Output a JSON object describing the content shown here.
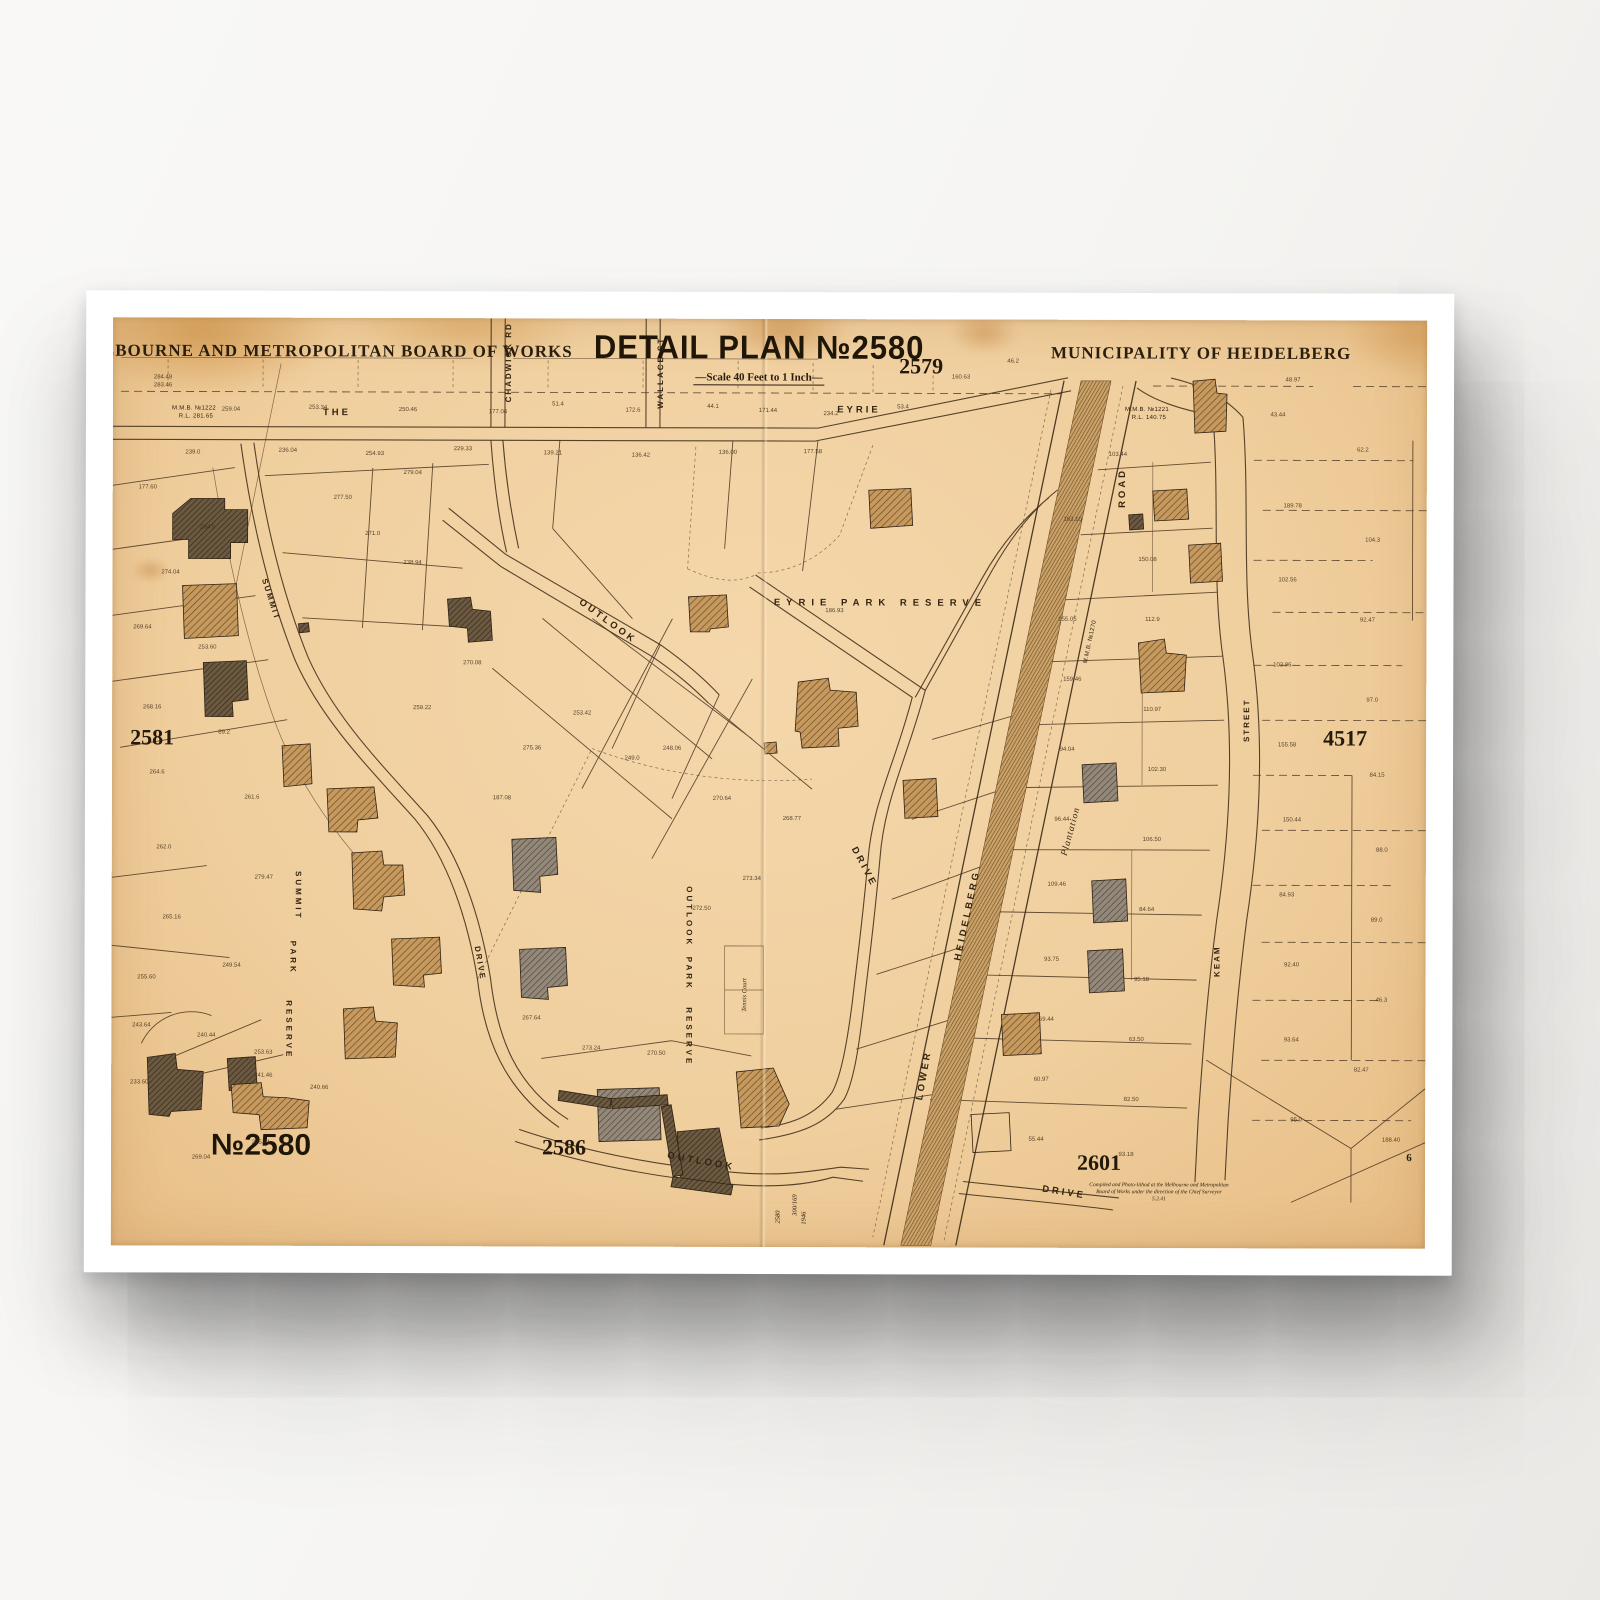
{
  "scene": {
    "description": "Framed vintage cadastral map print hanging on a wall"
  },
  "colors": {
    "paper": "#f0cf9e",
    "ink": "#3c2a16",
    "frame": "#ffffff",
    "wall": "#f6f5f3",
    "building_tan": "#c69a5f",
    "building_gray": "#938879",
    "building_dark": "#6b5a41",
    "plantation": "#7a5426"
  },
  "map": {
    "header": {
      "board_title": "MELBOURNE AND METROPOLITAN BOARD OF WORKS",
      "plan_title": "DETAIL PLAN №2580",
      "scale_note": "—Scale 40 Feet to 1 Inch—",
      "municipality": "MUNICIPALITY OF HEIDELBERG"
    },
    "labels": [
      {
        "id": "board-title",
        "t": "MELBOURNE AND METROPOLITAN BOARD OF WORKS",
        "x": 210,
        "y": 33,
        "c": "t-board"
      },
      {
        "id": "plan-title",
        "t": "DETAIL PLAN №2580",
        "x": 646,
        "y": 28,
        "c": "t-plan"
      },
      {
        "id": "scale-note",
        "t": "—Scale 40 Feet to 1 Inch—",
        "x": 646,
        "y": 60,
        "c": "t-scale"
      },
      {
        "id": "municipality",
        "t": "MUNICIPALITY OF HEIDELBERG",
        "x": 1088,
        "y": 33,
        "c": "t-muni"
      },
      {
        "id": "adj-plan-2579",
        "t": "2579",
        "x": 808,
        "y": 47,
        "c": "t-adj"
      },
      {
        "id": "adj-plan-2581",
        "t": "2581",
        "x": 40,
        "y": 420,
        "c": "t-adj"
      },
      {
        "id": "adj-plan-4517",
        "t": "4517",
        "x": 1233,
        "y": 418,
        "c": "t-adj"
      },
      {
        "id": "plan-no-2580",
        "t": "№2580",
        "x": 150,
        "y": 828,
        "c": "t-adj-big"
      },
      {
        "id": "adj-plan-2586",
        "t": "2586",
        "x": 453,
        "y": 829,
        "c": "t-adj"
      },
      {
        "id": "adj-plan-2601",
        "t": "2601",
        "x": 988,
        "y": 843,
        "c": "t-adj"
      },
      {
        "id": "street-the",
        "t": "THE",
        "x": 224,
        "y": 95,
        "c": "t-street"
      },
      {
        "id": "street-eyrie",
        "t": "EYRIE",
        "x": 746,
        "y": 91,
        "c": "t-street"
      },
      {
        "id": "street-chadwick",
        "t": "CHADWICK RD",
        "x": 396,
        "y": 44,
        "r": -90,
        "c": "t-street-sm"
      },
      {
        "id": "street-wallace",
        "t": "WALLACE ST",
        "x": 548,
        "y": 54,
        "r": -90,
        "c": "t-street-sm"
      },
      {
        "id": "street-summit",
        "t": "SUMMIT",
        "x": 158,
        "y": 282,
        "r": 72,
        "c": "t-street-sm"
      },
      {
        "id": "street-summit-drive",
        "t": "DRIVE",
        "x": 368,
        "y": 645,
        "r": 80,
        "c": "t-street-sm"
      },
      {
        "id": "street-outlook-upper",
        "t": "OUTLOOK",
        "x": 495,
        "y": 303,
        "r": 36,
        "c": "t-street"
      },
      {
        "id": "street-drive-upper",
        "t": "DRIVE",
        "x": 752,
        "y": 548,
        "r": 62,
        "c": "t-street"
      },
      {
        "id": "street-outlook-lower",
        "t": "OUTLOOK",
        "x": 590,
        "y": 843,
        "r": 10,
        "c": "t-street"
      },
      {
        "id": "street-drive-lower",
        "t": "DRIVE",
        "x": 953,
        "y": 873,
        "r": 9,
        "c": "t-street"
      },
      {
        "id": "street-lower",
        "t": "LOWER",
        "x": 813,
        "y": 756,
        "r": -80,
        "c": "t-street"
      },
      {
        "id": "street-heidelberg",
        "t": "HEIDELBERG",
        "x": 856,
        "y": 596,
        "r": -78,
        "c": "t-street"
      },
      {
        "id": "street-road",
        "t": "ROAD",
        "x": 1010,
        "y": 168,
        "r": -90,
        "c": "t-street"
      },
      {
        "id": "plantation",
        "t": "Plantation",
        "x": 960,
        "y": 512,
        "r": -75,
        "c": "t-plant"
      },
      {
        "id": "street-keam",
        "t": "KEAM",
        "x": 1106,
        "y": 641,
        "r": -90,
        "c": "t-street-sm"
      },
      {
        "id": "street-street",
        "t": "STREET",
        "x": 1135,
        "y": 400,
        "r": -90,
        "c": "t-street-sm"
      },
      {
        "id": "eyrie-park-reserve",
        "t": "EYRIE  PARK  RESERVE",
        "x": 768,
        "y": 284,
        "c": "t-reserve"
      },
      {
        "id": "outlook-park-1",
        "t": "OUTLOOK",
        "x": 577,
        "y": 598,
        "r": 90,
        "c": "t-reserve-sm"
      },
      {
        "id": "outlook-park-2",
        "t": "PARK",
        "x": 577,
        "y": 655,
        "r": 90,
        "c": "t-reserve-sm"
      },
      {
        "id": "outlook-park-3",
        "t": "RESERVE",
        "x": 577,
        "y": 718,
        "r": 90,
        "c": "t-reserve-sm"
      },
      {
        "id": "summit-park-1",
        "t": "SUMMIT",
        "x": 186,
        "y": 578,
        "r": 90,
        "c": "t-reserve-sm"
      },
      {
        "id": "summit-park-2",
        "t": "PARK",
        "x": 181,
        "y": 640,
        "r": 90,
        "c": "t-reserve-sm"
      },
      {
        "id": "summit-park-3",
        "t": "RESERVE",
        "x": 177,
        "y": 712,
        "r": 90,
        "c": "t-reserve-sm"
      },
      {
        "id": "mmb-1222",
        "t": "M.M.B. №1222",
        "x": 81,
        "y": 91,
        "c": "t-tiny"
      },
      {
        "id": "mmb-1222-rl",
        "t": "R.L. 281.65",
        "x": 83,
        "y": 99,
        "c": "t-tiny"
      },
      {
        "id": "mmb-1221",
        "t": "M.M.B. №1221",
        "x": 1034,
        "y": 90,
        "c": "t-tiny"
      },
      {
        "id": "mmb-1221-rl",
        "t": "R.L. 140.75",
        "x": 1036,
        "y": 98,
        "c": "t-tiny"
      },
      {
        "id": "mmb-1270",
        "t": "M.M.B. №1270",
        "x": 978,
        "y": 322,
        "r": -78,
        "c": "t-tiny"
      },
      {
        "id": "tennis-court",
        "t": "Tennis Court",
        "x": 634,
        "y": 676,
        "r": -90,
        "c": "t-hand"
      },
      {
        "id": "compiled-note-1",
        "t": "Compiled and Photo-lithod at the Melbourne and Metropolitan",
        "x": 1048,
        "y": 866,
        "c": "t-note"
      },
      {
        "id": "compiled-note-2",
        "t": "Board of Works under the direction of the Chief Surveyor",
        "x": 1048,
        "y": 873,
        "c": "t-note"
      },
      {
        "id": "compiled-note-3",
        "t": "5.2.41",
        "x": 1048,
        "y": 880,
        "c": "t-note"
      },
      {
        "id": "fold-note-a",
        "t": "2580",
        "x": 668,
        "y": 898,
        "r": -90,
        "c": "t-hand"
      },
      {
        "id": "fold-note-b",
        "t": "300/169",
        "x": 685,
        "y": 886,
        "r": -90,
        "c": "t-hand"
      },
      {
        "id": "fold-note-c",
        "t": "1946",
        "x": 694,
        "y": 899,
        "r": -90,
        "c": "t-hand"
      },
      {
        "id": "mark-6",
        "t": "6",
        "x": 1298,
        "y": 838,
        "c": "t-six"
      },
      {
        "t": "284.48",
        "x": 50,
        "y": 60,
        "c": "lot"
      },
      {
        "t": "283.46",
        "x": 50,
        "y": 68,
        "c": "lot"
      },
      {
        "t": "259.04",
        "x": 118,
        "y": 92,
        "c": "lot"
      },
      {
        "t": "253.34",
        "x": 205,
        "y": 90,
        "c": "lot"
      },
      {
        "t": "250.46",
        "x": 295,
        "y": 92,
        "c": "lot"
      },
      {
        "t": "177.04",
        "x": 385,
        "y": 94,
        "c": "lot"
      },
      {
        "t": "51.4",
        "x": 445,
        "y": 86,
        "c": "lot"
      },
      {
        "t": "172.6",
        "x": 520,
        "y": 92,
        "c": "lot"
      },
      {
        "t": "44.1",
        "x": 600,
        "y": 88,
        "c": "lot"
      },
      {
        "t": "171.44",
        "x": 655,
        "y": 92,
        "c": "lot"
      },
      {
        "t": "234.2",
        "x": 718,
        "y": 95,
        "c": "lot"
      },
      {
        "t": "53.4",
        "x": 790,
        "y": 88,
        "c": "lot"
      },
      {
        "t": "160.63",
        "x": 848,
        "y": 58,
        "c": "lot"
      },
      {
        "t": "46.2",
        "x": 900,
        "y": 42,
        "c": "lot"
      },
      {
        "t": "239.0",
        "x": 80,
        "y": 135,
        "c": "lot"
      },
      {
        "t": "236.04",
        "x": 175,
        "y": 133,
        "c": "lot"
      },
      {
        "t": "254.93",
        "x": 262,
        "y": 136,
        "c": "lot"
      },
      {
        "t": "229.33",
        "x": 350,
        "y": 131,
        "c": "lot"
      },
      {
        "t": "139.21",
        "x": 440,
        "y": 135,
        "c": "lot"
      },
      {
        "t": "136.42",
        "x": 528,
        "y": 137,
        "c": "lot"
      },
      {
        "t": "136.00",
        "x": 615,
        "y": 134,
        "c": "lot"
      },
      {
        "t": "177.58",
        "x": 700,
        "y": 133,
        "c": "lot"
      },
      {
        "t": "177.60",
        "x": 35,
        "y": 170,
        "c": "lot"
      },
      {
        "t": "284.5",
        "x": 95,
        "y": 210,
        "c": "lot"
      },
      {
        "t": "274.04",
        "x": 58,
        "y": 255,
        "c": "lot"
      },
      {
        "t": "269.64",
        "x": 30,
        "y": 310,
        "c": "lot"
      },
      {
        "t": "253.60",
        "x": 95,
        "y": 330,
        "c": "lot"
      },
      {
        "t": "268.16",
        "x": 40,
        "y": 390,
        "c": "lot"
      },
      {
        "t": "89.2",
        "x": 112,
        "y": 415,
        "c": "lot"
      },
      {
        "t": "264.6",
        "x": 45,
        "y": 455,
        "c": "lot"
      },
      {
        "t": "261.6",
        "x": 140,
        "y": 480,
        "c": "lot"
      },
      {
        "t": "262.0",
        "x": 52,
        "y": 530,
        "c": "lot"
      },
      {
        "t": "279.47",
        "x": 152,
        "y": 560,
        "c": "lot"
      },
      {
        "t": "265.16",
        "x": 60,
        "y": 600,
        "c": "lot"
      },
      {
        "t": "255.60",
        "x": 35,
        "y": 660,
        "c": "lot"
      },
      {
        "t": "249.54",
        "x": 120,
        "y": 648,
        "c": "lot"
      },
      {
        "t": "243.64",
        "x": 30,
        "y": 708,
        "c": "lot"
      },
      {
        "t": "240.44",
        "x": 95,
        "y": 718,
        "c": "lot"
      },
      {
        "t": "253.63",
        "x": 152,
        "y": 735,
        "c": "lot"
      },
      {
        "t": "233.60",
        "x": 28,
        "y": 765,
        "c": "lot"
      },
      {
        "t": "269.04",
        "x": 90,
        "y": 840,
        "c": "lot"
      },
      {
        "t": "275.41",
        "x": 150,
        "y": 825,
        "c": "lot"
      },
      {
        "t": "241.46",
        "x": 152,
        "y": 758,
        "c": "lot"
      },
      {
        "t": "240.66",
        "x": 208,
        "y": 770,
        "c": "lot"
      },
      {
        "t": "271.0",
        "x": 260,
        "y": 216,
        "c": "lot"
      },
      {
        "t": "238.94",
        "x": 300,
        "y": 245,
        "c": "lot"
      },
      {
        "t": "279.04",
        "x": 300,
        "y": 155,
        "c": "lot"
      },
      {
        "t": "277.50",
        "x": 230,
        "y": 180,
        "c": "lot"
      },
      {
        "t": "270.08",
        "x": 360,
        "y": 345,
        "c": "lot"
      },
      {
        "t": "259.22",
        "x": 310,
        "y": 390,
        "c": "lot"
      },
      {
        "t": "275.36",
        "x": 420,
        "y": 430,
        "c": "lot"
      },
      {
        "t": "253.42",
        "x": 470,
        "y": 395,
        "c": "lot"
      },
      {
        "t": "249.0",
        "x": 520,
        "y": 440,
        "c": "lot"
      },
      {
        "t": "187.08",
        "x": 390,
        "y": 480,
        "c": "lot"
      },
      {
        "t": "248.06",
        "x": 560,
        "y": 430,
        "c": "lot"
      },
      {
        "t": "270.64",
        "x": 610,
        "y": 480,
        "c": "lot"
      },
      {
        "t": "268.77",
        "x": 680,
        "y": 500,
        "c": "lot"
      },
      {
        "t": "273.34",
        "x": 640,
        "y": 560,
        "c": "lot"
      },
      {
        "t": "272.50",
        "x": 590,
        "y": 590,
        "c": "lot"
      },
      {
        "t": "186.93",
        "x": 722,
        "y": 292,
        "c": "lot"
      },
      {
        "t": "267.64",
        "x": 420,
        "y": 700,
        "c": "lot"
      },
      {
        "t": "273.24",
        "x": 480,
        "y": 730,
        "c": "lot"
      },
      {
        "t": "270.50",
        "x": 545,
        "y": 735,
        "c": "lot"
      },
      {
        "t": "163.10",
        "x": 960,
        "y": 200,
        "c": "lot"
      },
      {
        "t": "103.44",
        "x": 1005,
        "y": 135,
        "c": "lot"
      },
      {
        "t": "150.08",
        "x": 1035,
        "y": 240,
        "c": "lot"
      },
      {
        "t": "155.05",
        "x": 955,
        "y": 300,
        "c": "lot"
      },
      {
        "t": "112.9",
        "x": 1040,
        "y": 300,
        "c": "lot"
      },
      {
        "t": "159.46",
        "x": 960,
        "y": 360,
        "c": "lot"
      },
      {
        "t": "110.97",
        "x": 1040,
        "y": 390,
        "c": "lot"
      },
      {
        "t": "94.04",
        "x": 955,
        "y": 430,
        "c": "lot"
      },
      {
        "t": "102.30",
        "x": 1045,
        "y": 450,
        "c": "lot"
      },
      {
        "t": "96.44",
        "x": 950,
        "y": 500,
        "c": "lot"
      },
      {
        "t": "106.50",
        "x": 1040,
        "y": 520,
        "c": "lot"
      },
      {
        "t": "109.46",
        "x": 945,
        "y": 565,
        "c": "lot"
      },
      {
        "t": "84.64",
        "x": 1035,
        "y": 590,
        "c": "lot"
      },
      {
        "t": "93.75",
        "x": 940,
        "y": 640,
        "c": "lot"
      },
      {
        "t": "95.18",
        "x": 1030,
        "y": 660,
        "c": "lot"
      },
      {
        "t": "69.44",
        "x": 935,
        "y": 700,
        "c": "lot"
      },
      {
        "t": "63.50",
        "x": 1025,
        "y": 720,
        "c": "lot"
      },
      {
        "t": "60.97",
        "x": 930,
        "y": 760,
        "c": "lot"
      },
      {
        "t": "82.50",
        "x": 1020,
        "y": 780,
        "c": "lot"
      },
      {
        "t": "55.44",
        "x": 925,
        "y": 820,
        "c": "lot"
      },
      {
        "t": "93.18",
        "x": 1015,
        "y": 835,
        "c": "lot"
      },
      {
        "t": "48.97",
        "x": 1180,
        "y": 60,
        "c": "lot"
      },
      {
        "t": "43.44",
        "x": 1165,
        "y": 95,
        "c": "lot"
      },
      {
        "t": "62.2",
        "x": 1250,
        "y": 130,
        "c": "lot"
      },
      {
        "t": "189.78",
        "x": 1180,
        "y": 186,
        "c": "lot"
      },
      {
        "t": "104.3",
        "x": 1260,
        "y": 220,
        "c": "lot"
      },
      {
        "t": "102.56",
        "x": 1175,
        "y": 260,
        "c": "lot"
      },
      {
        "t": "92.47",
        "x": 1255,
        "y": 300,
        "c": "lot"
      },
      {
        "t": "103.96",
        "x": 1170,
        "y": 345,
        "c": "lot"
      },
      {
        "t": "97.0",
        "x": 1260,
        "y": 380,
        "c": "lot"
      },
      {
        "t": "155.58",
        "x": 1175,
        "y": 425,
        "c": "lot"
      },
      {
        "t": "84.15",
        "x": 1265,
        "y": 455,
        "c": "lot"
      },
      {
        "t": "150.44",
        "x": 1180,
        "y": 500,
        "c": "lot"
      },
      {
        "t": "88.0",
        "x": 1270,
        "y": 530,
        "c": "lot"
      },
      {
        "t": "84.93",
        "x": 1175,
        "y": 575,
        "c": "lot"
      },
      {
        "t": "89.0",
        "x": 1265,
        "y": 600,
        "c": "lot"
      },
      {
        "t": "92.40",
        "x": 1180,
        "y": 645,
        "c": "lot"
      },
      {
        "t": "46.3",
        "x": 1270,
        "y": 680,
        "c": "lot"
      },
      {
        "t": "93.64",
        "x": 1180,
        "y": 720,
        "c": "lot"
      },
      {
        "t": "82.47",
        "x": 1250,
        "y": 750,
        "c": "lot"
      },
      {
        "t": "95.0",
        "x": 1185,
        "y": 800,
        "c": "lot"
      },
      {
        "t": "188.40",
        "x": 1280,
        "y": 820,
        "c": "lot"
      }
    ]
  }
}
